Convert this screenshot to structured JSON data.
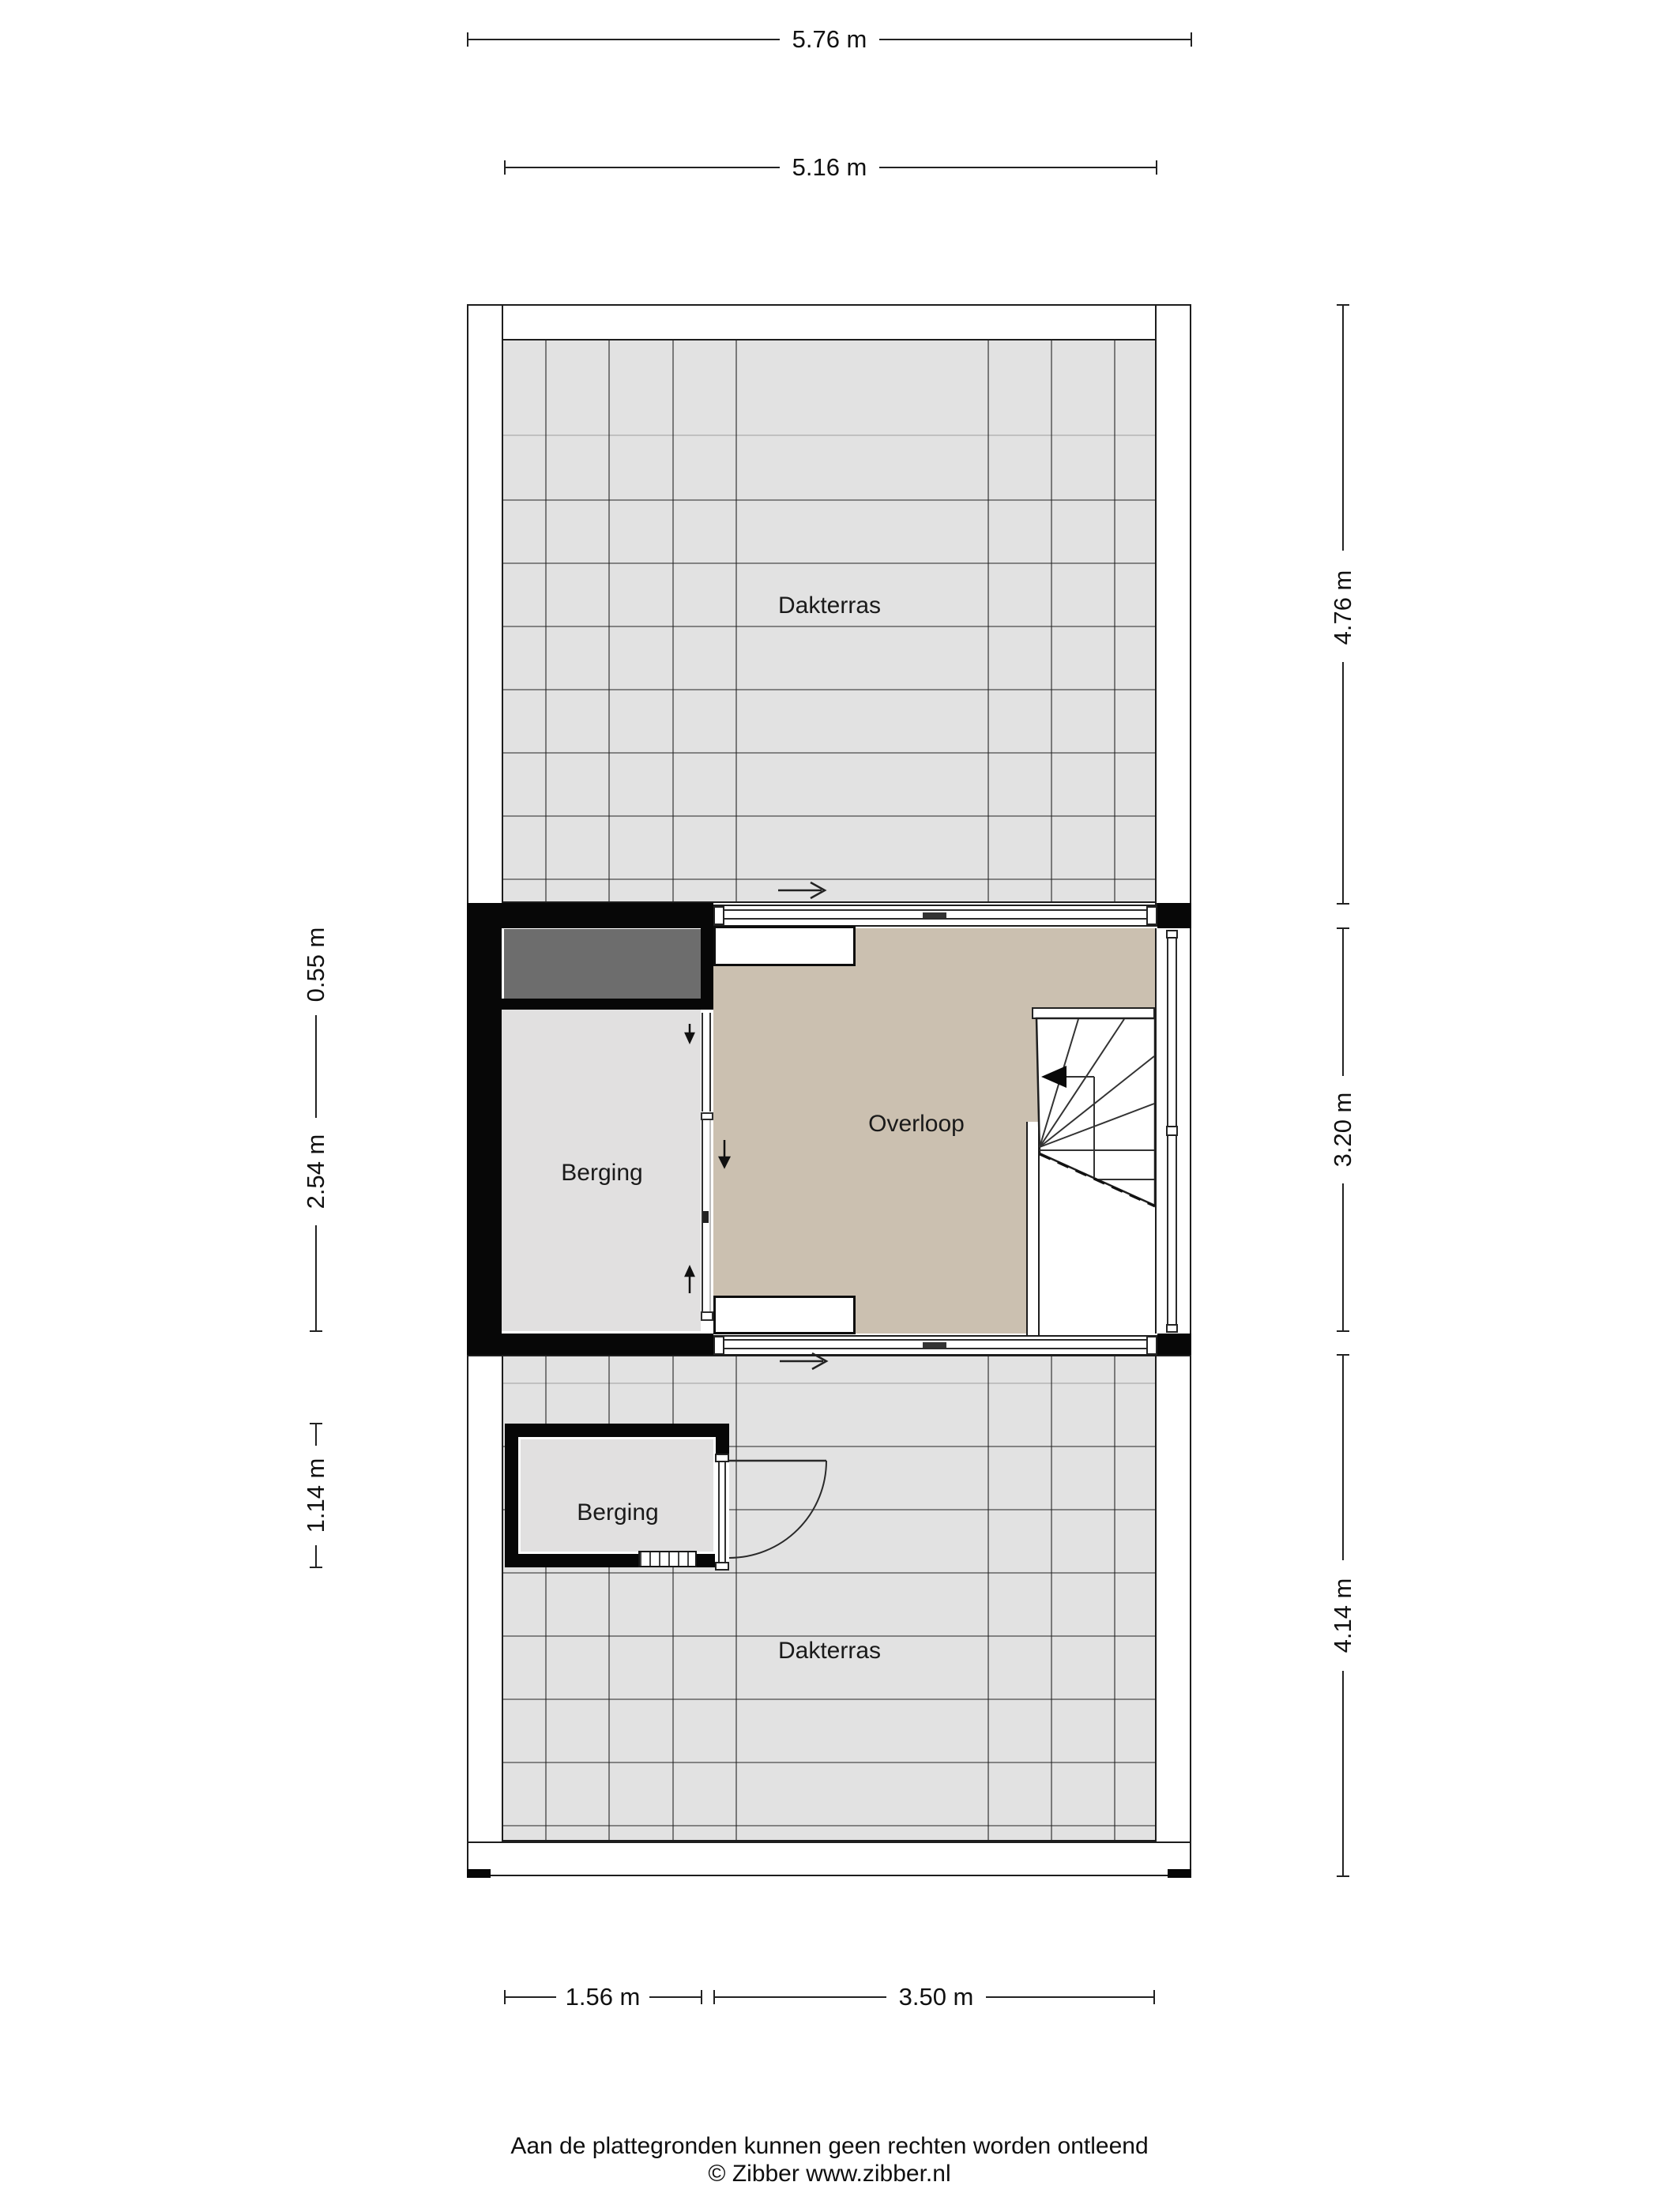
{
  "rooms": {
    "dakterras_top": "Dakterras",
    "overloop": "Overloop",
    "berging_mid": "Berging",
    "berging_bottom": "Berging",
    "dakterras_bottom": "Dakterras"
  },
  "dimensions": {
    "top_outer": "5.76 m",
    "top_inner": "5.16 m",
    "left": [
      "0.55 m",
      "2.54 m",
      "1.14 m"
    ],
    "right": [
      "4.76 m",
      "3.20 m",
      "4.14 m"
    ],
    "bottom": [
      "1.56 m",
      "3.50 m"
    ]
  },
  "footer": {
    "disclaimer": "Aan de plattegronden kunnen geen rechten worden ontleend",
    "credit": "© Zibber www.zibber.nl"
  },
  "colors": {
    "tile_gray": "#e2e2e2",
    "floor_gray": "#e1e0e0",
    "overloop_beige": "#cbc0b0",
    "void_dark_gray": "#6d6d6d",
    "wall_black": "#070707"
  }
}
